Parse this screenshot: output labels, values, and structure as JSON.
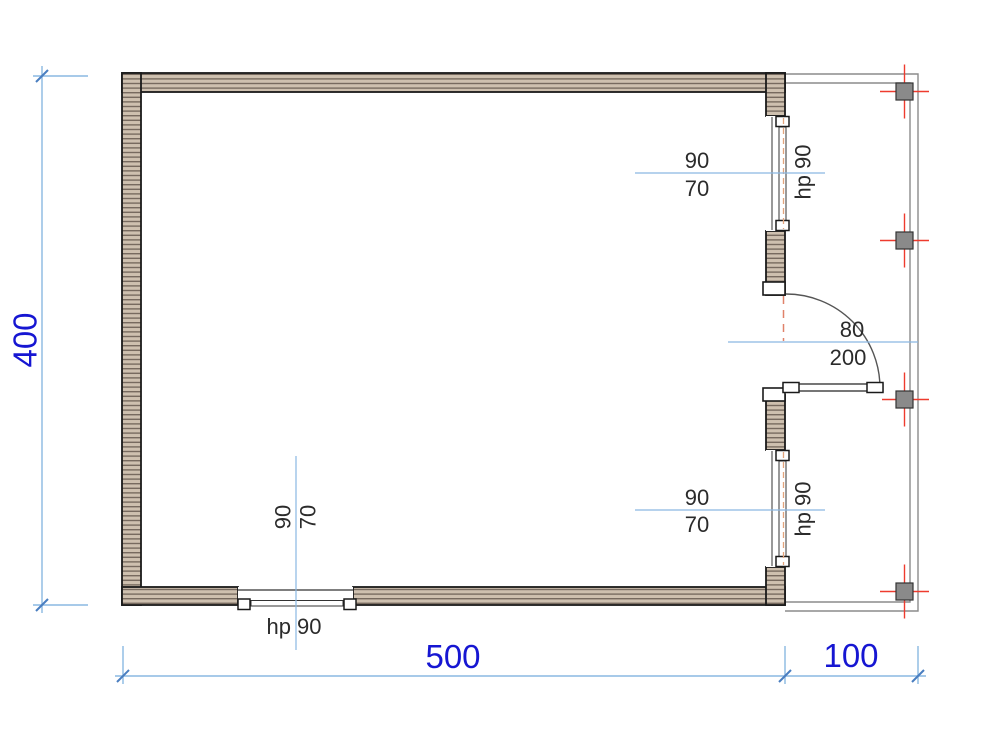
{
  "drawing_type": "floor-plan",
  "dimensions": {
    "overall_height": "400",
    "overall_width": "500",
    "terrace_width": "100"
  },
  "door": {
    "width": "80",
    "height": "200"
  },
  "windows": {
    "top_right": {
      "size": "90",
      "sill": "70",
      "parapet": "hp 90"
    },
    "bottom_right": {
      "size": "90",
      "sill": "70",
      "parapet": "hp 90"
    },
    "bottom": {
      "size": "90",
      "sill": "70",
      "parapet": "hp 90"
    }
  },
  "colors": {
    "dimension_text_blue": "#1616d2",
    "dimension_line_blue": "#8ab8e2",
    "dimension_tick_blue": "#4a7ec0",
    "annotation_text": "#2b2b2b",
    "wall_fill": "#cec0af",
    "wall_hatch_line": "#776a5f",
    "wall_outline": "#1a1a1a",
    "column_fill": "#8a8a8a",
    "column_outline": "#333333",
    "centerline_red": "#ee3b2e",
    "opening_dashed": "#e2a37c",
    "terrace_outline": "#8c8c8c",
    "door_arc": "#555555"
  }
}
